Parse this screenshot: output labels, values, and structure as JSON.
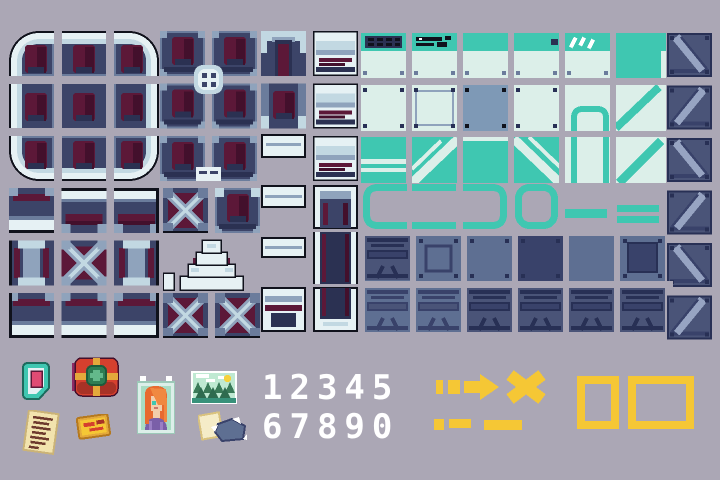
{
  "sheet": {
    "title": "sci-fi pixel tileset and item sprites",
    "canvas": {
      "width": 720,
      "height": 480
    }
  },
  "palette": {
    "bg": "#ABA7B5",
    "ink": "#10121C",
    "navy": "#3C4468",
    "navy2": "#2B3152",
    "mar": "#5C1838",
    "mar2": "#43102C",
    "steel": "#8FA3BC",
    "steel2": "#6B7C9C",
    "pale": "#E6F1F4",
    "pale2": "#C2D8E2",
    "teal": "#3FC7B1",
    "mint": "#DCEFE9",
    "sblue": "#7E99B6",
    "slate": "#5E6F92",
    "slate2": "#4A5478",
    "slate3": "#39426A",
    "slate4": "#283055",
    "strut": "#97A4C2",
    "white": "#FFFFFF",
    "yellow": "#F5C735",
    "red": "#D5402E",
    "red2": "#A83226",
    "magenta": "#8E2A63",
    "green": "#2E7D53",
    "green2": "#63B98B",
    "pink": "#E04B74",
    "cream": "#F2E3AE",
    "gold": "#E3A93B",
    "skin": "#F3CDAA",
    "hair": "#E86A2F",
    "hair2": "#F08840",
    "purple": "#7A5FA8",
    "purple2": "#9A7FC4",
    "tgreen": "#2E6B4F",
    "tgreen2": "#3A7A58",
    "sky": "#BFE9D2",
    "scrib": "#6E3A2E"
  },
  "sprites": {
    "digits_row1": "12345",
    "digits_row2": "67890"
  },
  "placements": [
    {
      "name": "rounded-room-tiles",
      "symbol": "round_room",
      "x": 9,
      "y": 31
    },
    {
      "name": "navy-wall-tiles",
      "symbol": "navy_block",
      "x": 160,
      "y": 31
    },
    {
      "name": "column-wall-tiles",
      "symbol": "column_tiles",
      "x": 261,
      "y": 31
    },
    {
      "name": "side-wall-tiles",
      "symbol": "side_tiles",
      "x": 313,
      "y": 31
    },
    {
      "name": "teal-panel-tiles",
      "symbol": "teal_block",
      "x": 361,
      "y": 33
    },
    {
      "name": "strut-tile-column",
      "symbol": "strut_col",
      "x": 667,
      "y": 33
    },
    {
      "name": "outlined-room-tiles",
      "symbol": "black_room",
      "x": 9,
      "y": 188
    },
    {
      "name": "stairs-and-crate-tiles",
      "symbol": "mid_block",
      "x": 163,
      "y": 188
    },
    {
      "name": "small-wall-tiles",
      "symbol": "small_tiles",
      "x": 261,
      "y": 185
    },
    {
      "name": "door-corridor-tiles",
      "symbol": "door_tiles",
      "x": 313,
      "y": 185
    },
    {
      "name": "teal-bracket-markers",
      "symbol": "bracket_row",
      "x": 363,
      "y": 184
    },
    {
      "name": "slate-crate-tiles",
      "symbol": "slate_rows",
      "x": 365,
      "y": 236
    },
    {
      "name": "card-badge-icon",
      "symbol": "i_card",
      "x": 20,
      "y": 360
    },
    {
      "name": "supply-box-icon",
      "symbol": "i_box",
      "x": 72,
      "y": 357
    },
    {
      "name": "note-icon",
      "symbol": "i_note",
      "x": 22,
      "y": 410
    },
    {
      "name": "ticket-icon",
      "symbol": "i_ticket",
      "x": 76,
      "y": 414
    },
    {
      "name": "portrait-icon",
      "symbol": "i_portrait",
      "x": 137,
      "y": 376
    },
    {
      "name": "landscape-icon",
      "symbol": "i_landscape",
      "x": 191,
      "y": 371
    },
    {
      "name": "papers-icon",
      "symbol": "i_papers",
      "x": 198,
      "y": 410
    },
    {
      "name": "arrow-icon",
      "symbol": "i_arrow",
      "x": 436,
      "y": 372
    },
    {
      "name": "x-icon",
      "symbol": "i_x",
      "x": 504,
      "y": 370
    },
    {
      "name": "dash-marks-icon",
      "symbol": "i_marks",
      "x": 434,
      "y": 418
    },
    {
      "name": "square-frame-icon",
      "symbol": "i_sq",
      "x": 577,
      "y": 376
    },
    {
      "name": "rect-frame-icon",
      "symbol": "i_rect",
      "x": 628,
      "y": 376
    }
  ]
}
